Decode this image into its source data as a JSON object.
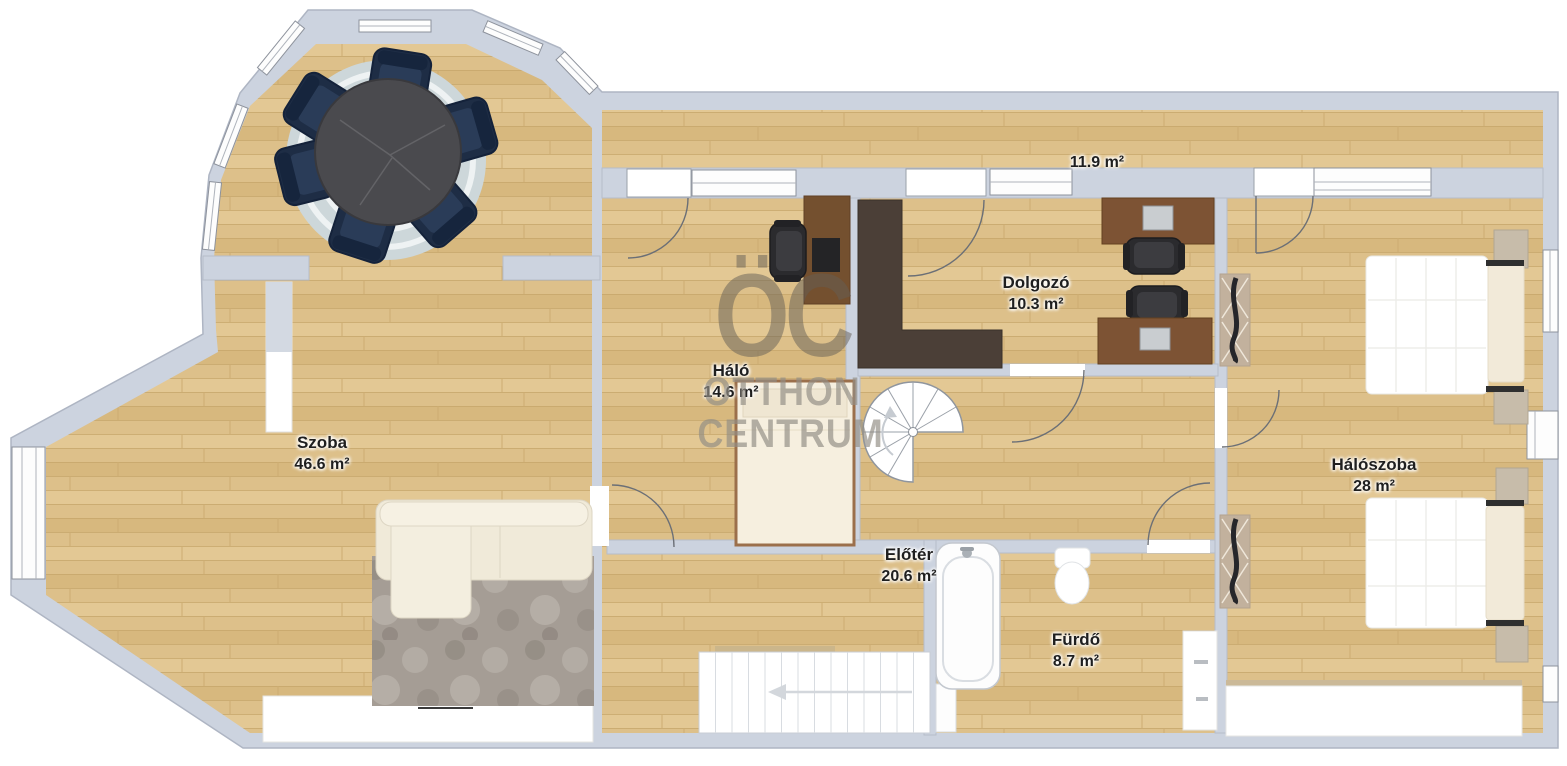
{
  "plan": {
    "rooms": [
      {
        "name": "Szoba",
        "area": "46.6 m²"
      },
      {
        "name": "Háló",
        "area": "14.6 m²"
      },
      {
        "name": "Dolgozó",
        "area": "10.3 m²"
      },
      {
        "name": "Előtér",
        "area": "20.6 m²"
      },
      {
        "name": "Fürdő",
        "area": "8.7 m²"
      },
      {
        "name": "Hálószoba",
        "area": "28 m²"
      },
      {
        "name": "",
        "area": "11.9 m²"
      }
    ],
    "watermark": {
      "logo": "ÖC",
      "line1": "OTTHON",
      "line2": "CENTRUM"
    },
    "colors": {
      "wall": "#ccd3df",
      "wall_edge": "#aeb5c3",
      "floor_wood": "#ddc08a",
      "navy_chair": "#1e2d45",
      "bed_frame": "#9b6f4b",
      "background": "#ffffff"
    }
  }
}
